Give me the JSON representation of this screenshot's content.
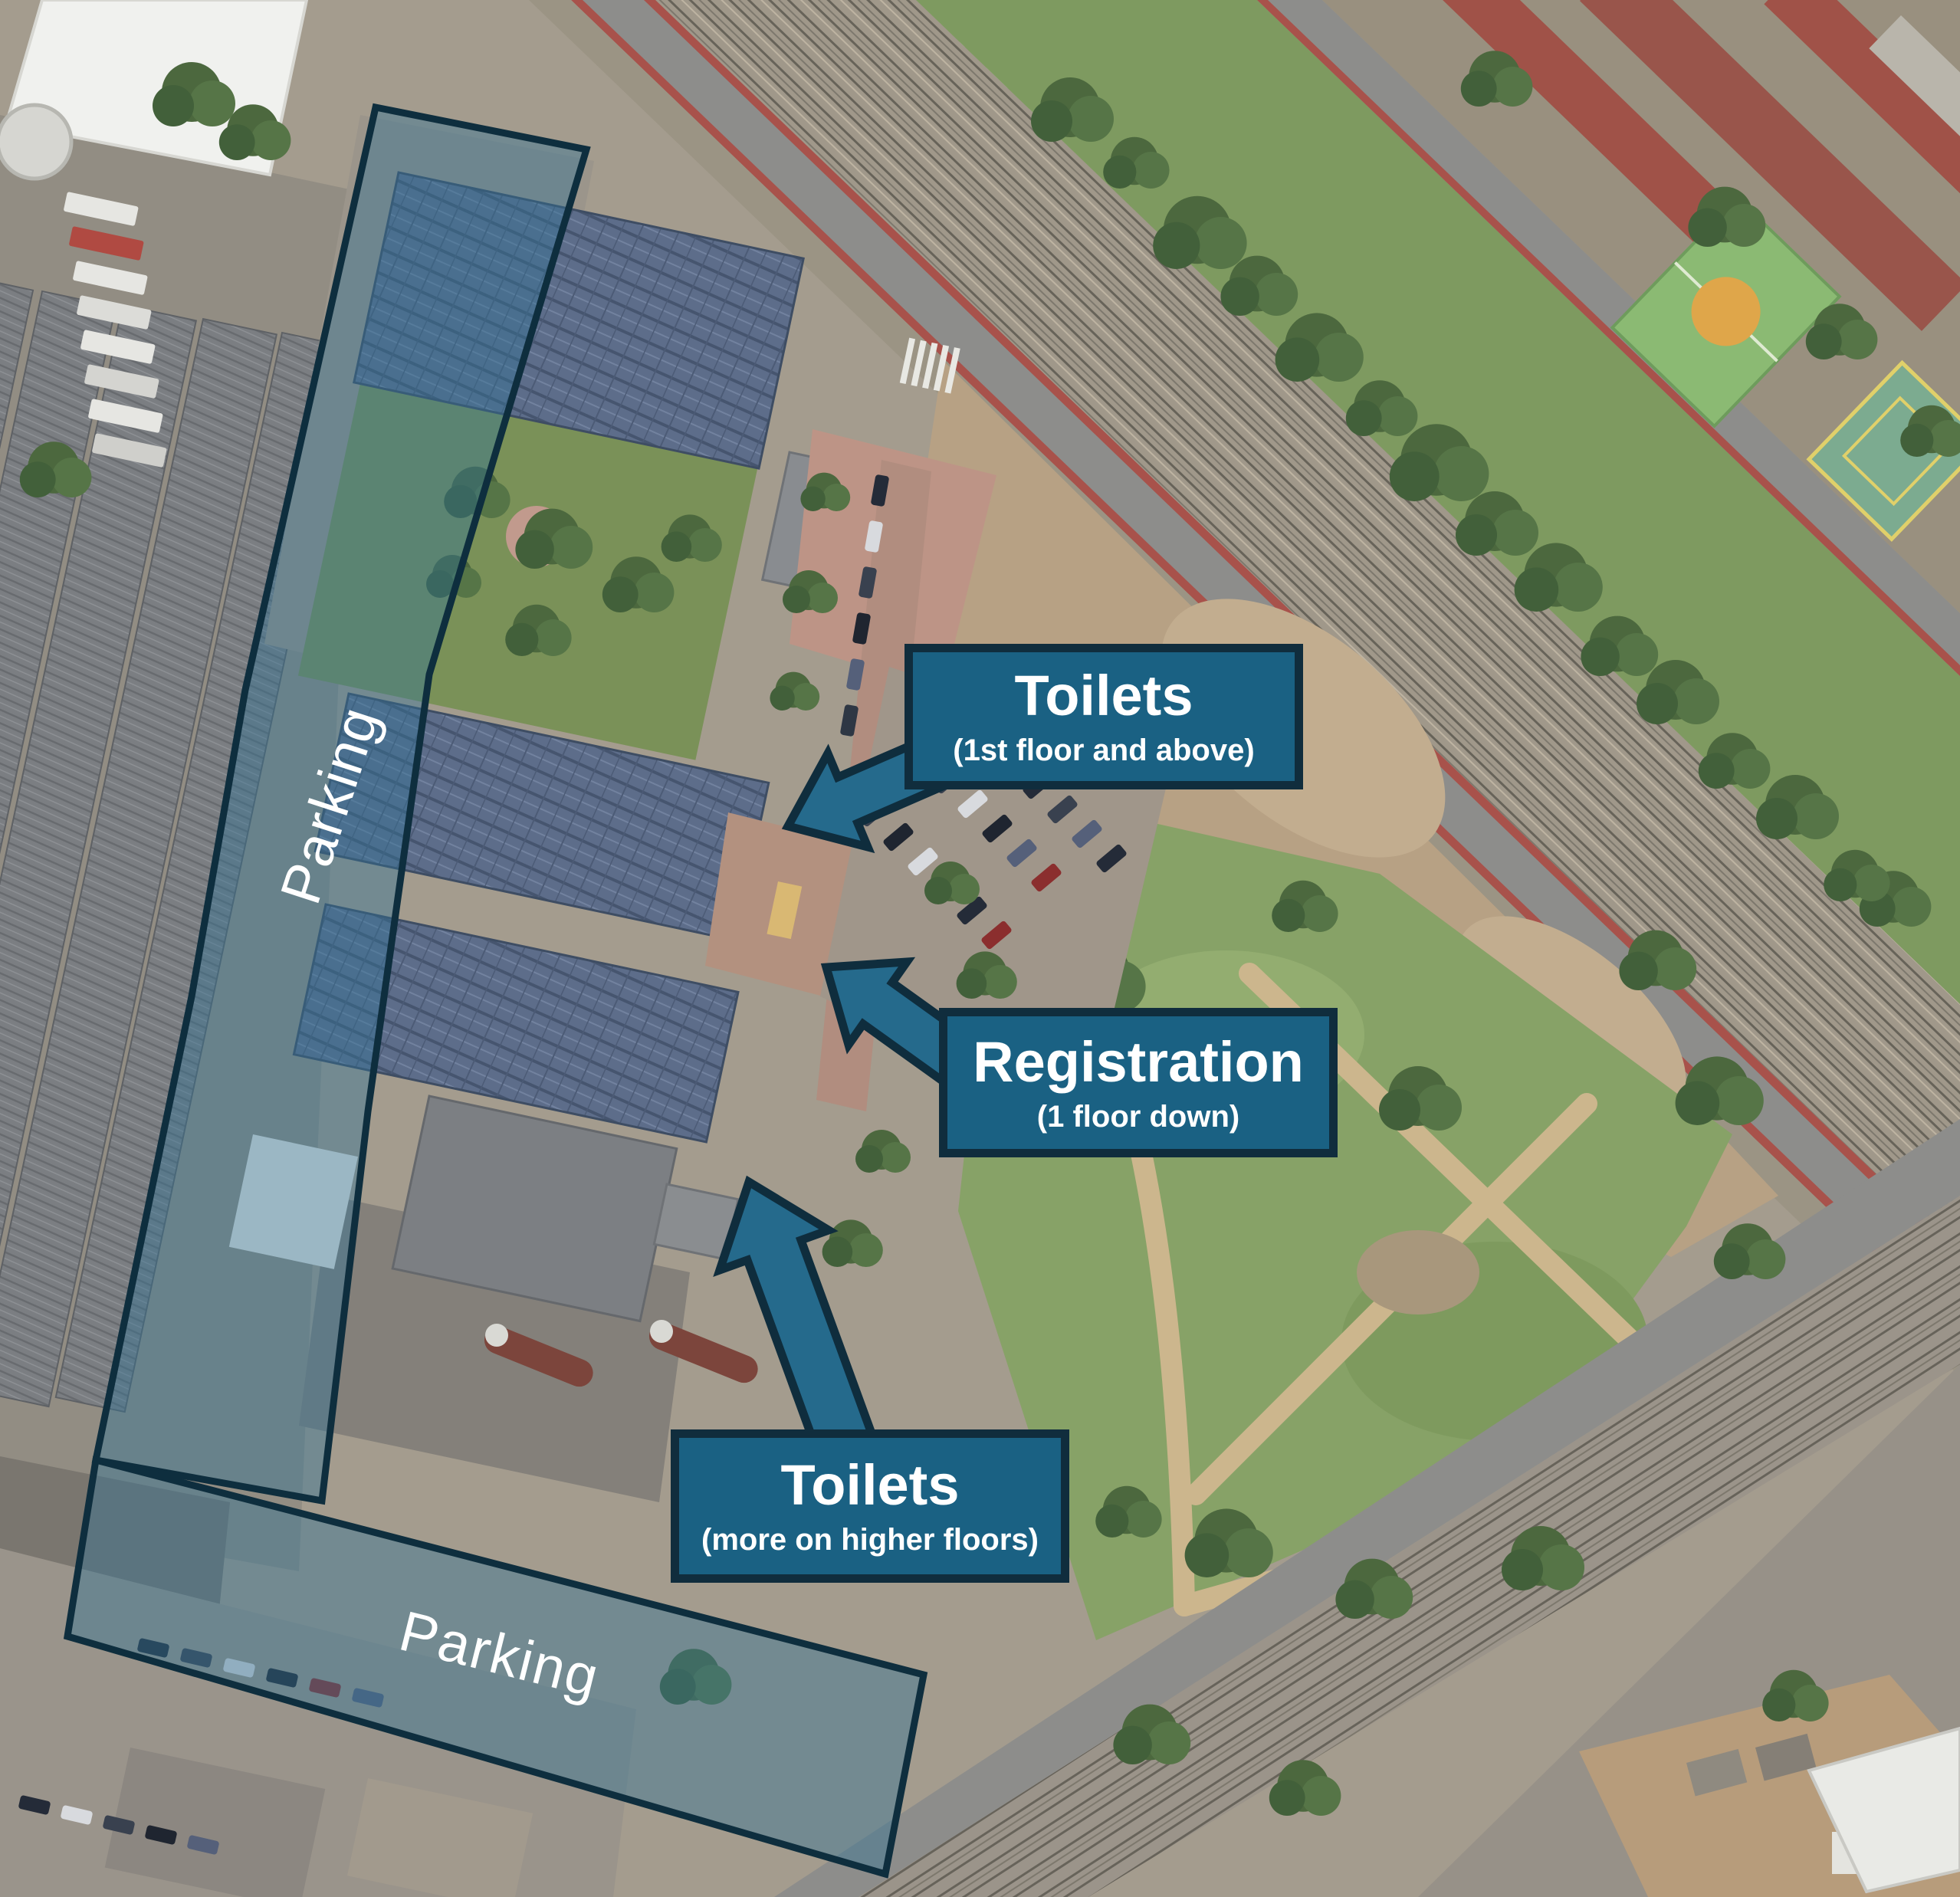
{
  "map": {
    "kind": "annotated-satellite-map",
    "colors": {
      "callout_fill": "#1a6183",
      "callout_border": "#102d3d",
      "arrow_fill": "#256a8c",
      "overlay_fill": "#2f7396",
      "overlay_border": "#0e2e3e",
      "label_text": "#ffffff"
    },
    "callouts": [
      {
        "id": "toilets-upper",
        "title": "Toilets",
        "subtitle": "(1st floor and above)"
      },
      {
        "id": "registration",
        "title": "Registration",
        "subtitle": "(1 floor down)"
      },
      {
        "id": "toilets-lower",
        "title": "Toilets",
        "subtitle": "(more on higher floors)"
      }
    ],
    "area_labels": {
      "parking_left": "Parking",
      "parking_bottom": "Parking"
    }
  }
}
